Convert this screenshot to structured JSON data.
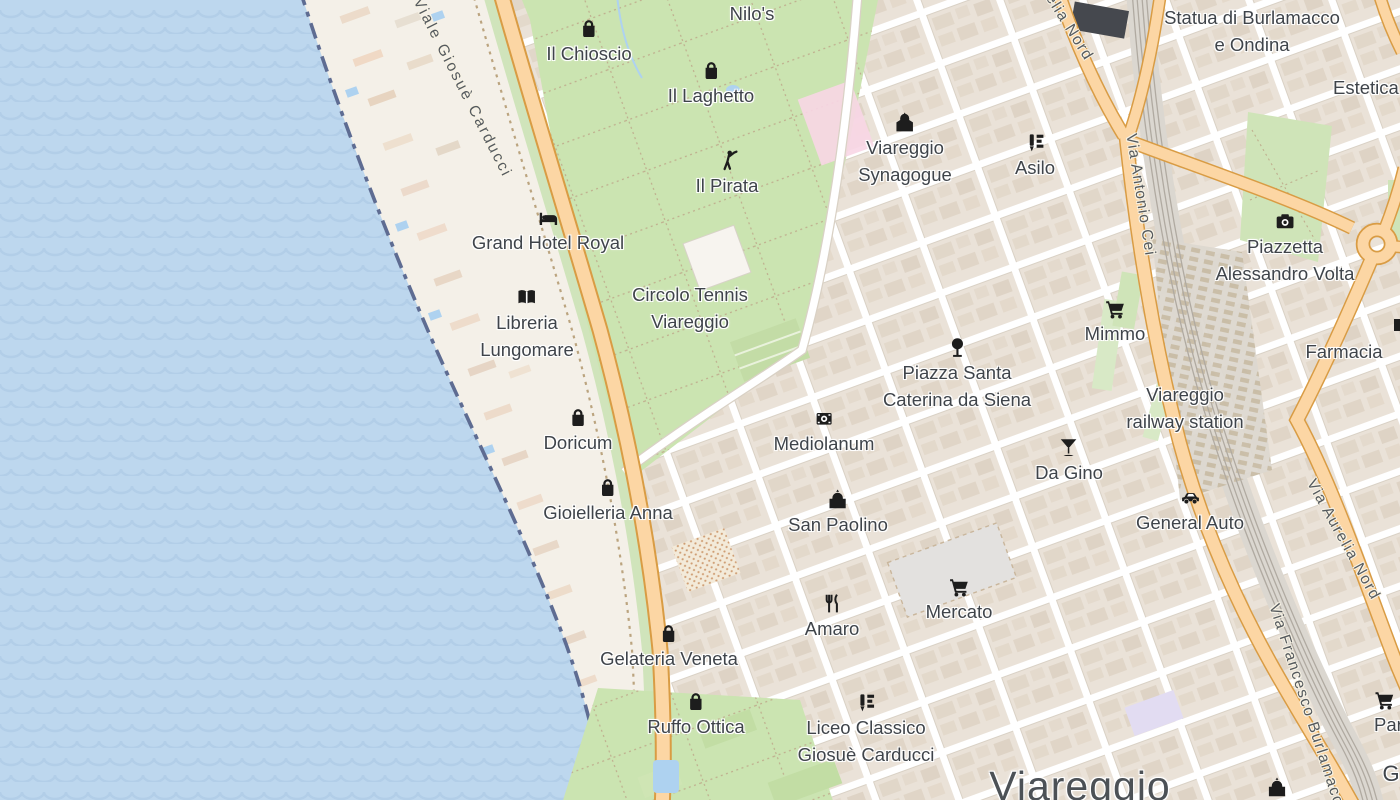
{
  "map": {
    "city_label": {
      "text": "Viareggio",
      "x": 1080,
      "y": 763
    },
    "pois": [
      {
        "id": "nilos",
        "x": 752,
        "y": 0,
        "icon": null,
        "lines": [
          "Nilo's"
        ]
      },
      {
        "id": "il-chioscio",
        "x": 589,
        "y": 18,
        "icon": "shopping-bag",
        "lines": [
          "Il Chioscio"
        ]
      },
      {
        "id": "il-laghetto",
        "x": 711,
        "y": 60,
        "icon": "shopping-bag",
        "lines": [
          "Il Laghetto"
        ]
      },
      {
        "id": "il-pirata",
        "x": 727,
        "y": 150,
        "icon": "golfer",
        "lines": [
          "Il Pirata"
        ]
      },
      {
        "id": "statua-burlamacco",
        "x": 1252,
        "y": 4,
        "icon": null,
        "lines": [
          "Statua di Burlamacco",
          "e Ondina"
        ]
      },
      {
        "id": "viareggio-synagogue",
        "x": 905,
        "y": 112,
        "icon": "synagogue",
        "lines": [
          "Viareggio",
          "Synagogue"
        ]
      },
      {
        "id": "asilo",
        "x": 1035,
        "y": 132,
        "icon": "school",
        "lines": [
          "Asilo"
        ]
      },
      {
        "id": "estetica",
        "x": 1333,
        "y": 74,
        "icon": null,
        "lines": [
          "Estetica"
        ],
        "anchor": "left"
      },
      {
        "id": "grand-hotel-royal",
        "x": 548,
        "y": 207,
        "icon": "bed",
        "lines": [
          "Grand Hotel Royal"
        ]
      },
      {
        "id": "piazzetta-volta",
        "x": 1285,
        "y": 211,
        "icon": "camera",
        "lines": [
          "Piazzetta",
          "Alessandro Volta"
        ]
      },
      {
        "id": "circolo-tennis",
        "x": 690,
        "y": 281,
        "icon": null,
        "lines": [
          "Circolo Tennis",
          "Viareggio"
        ]
      },
      {
        "id": "libreria-lungomare",
        "x": 527,
        "y": 287,
        "icon": "book",
        "lines": [
          "Libreria",
          "Lungomare"
        ]
      },
      {
        "id": "mimmo",
        "x": 1115,
        "y": 298,
        "icon": "cart",
        "lines": [
          "Mimmo"
        ]
      },
      {
        "id": "piazza-caterina",
        "x": 957,
        "y": 337,
        "icon": "tree",
        "lines": [
          "Piazza Santa",
          "Caterina da Siena"
        ]
      },
      {
        "id": "farmacia",
        "x": 1344,
        "y": 338,
        "icon": null,
        "lines": [
          "Farmacia"
        ]
      },
      {
        "id": "railway-station",
        "x": 1185,
        "y": 381,
        "icon": null,
        "lines": [
          "Viareggio",
          "railway station"
        ]
      },
      {
        "id": "doricum",
        "x": 578,
        "y": 407,
        "icon": "shopping-bag",
        "lines": [
          "Doricum"
        ]
      },
      {
        "id": "mediolanum",
        "x": 824,
        "y": 408,
        "icon": "bank",
        "lines": [
          "Mediolanum"
        ]
      },
      {
        "id": "da-gino",
        "x": 1069,
        "y": 437,
        "icon": "cocktail",
        "lines": [
          "Da Gino"
        ]
      },
      {
        "id": "gioielleria-anna",
        "x": 608,
        "y": 477,
        "icon": "shopping-bag",
        "lines": [
          "Gioielleria Anna"
        ]
      },
      {
        "id": "general-auto",
        "x": 1190,
        "y": 487,
        "icon": "car",
        "lines": [
          "General Auto"
        ]
      },
      {
        "id": "san-paolino",
        "x": 838,
        "y": 489,
        "icon": "church",
        "lines": [
          "San Paolino"
        ]
      },
      {
        "id": "mercato",
        "x": 959,
        "y": 576,
        "icon": "cart",
        "lines": [
          "Mercato"
        ]
      },
      {
        "id": "amaro",
        "x": 832,
        "y": 593,
        "icon": "restaurant",
        "lines": [
          "Amaro"
        ]
      },
      {
        "id": "gelateria-veneta",
        "x": 669,
        "y": 623,
        "icon": "shopping-bag",
        "lines": [
          "Gelateria Veneta"
        ]
      },
      {
        "id": "par-partial",
        "x": 1374,
        "y": 689,
        "icon": "cart",
        "lines": [
          "Par"
        ],
        "anchor": "left"
      },
      {
        "id": "ruffo-ottica",
        "x": 696,
        "y": 691,
        "icon": "shopping-bag",
        "lines": [
          "Ruffo Ottica"
        ]
      },
      {
        "id": "liceo-carducci",
        "x": 866,
        "y": 692,
        "icon": "school",
        "lines": [
          "Liceo Classico",
          "Giosuè Carducci"
        ]
      },
      {
        "id": "g-partial",
        "x": 1391,
        "y": 760,
        "icon": null,
        "lines": [
          "G"
        ],
        "size": 22
      },
      {
        "id": "church-bottom",
        "x": 1277,
        "y": 777,
        "icon": "church",
        "lines": []
      }
    ],
    "road_labels": [
      {
        "id": "viale-giosue-carducci",
        "text": "Viale Giosuè Carducci",
        "x": 462,
        "y": 88,
        "rot": 63,
        "ls": 2.2
      },
      {
        "id": "via-aurelia-nord-top",
        "text": "Via Aurelia Nord",
        "x": 1053,
        "y": 2,
        "rot": 58,
        "ls": 1.5
      },
      {
        "id": "via-antonio-cei",
        "text": "Via Antonio Cei",
        "x": 1140,
        "y": 195,
        "rot": 81,
        "ls": 1.2
      },
      {
        "id": "via-aurelia-nord-right",
        "text": "Via Aurelia Nord",
        "x": 1343,
        "y": 540,
        "rot": 61,
        "ls": 1.5
      },
      {
        "id": "via-francesco-burlamacchi",
        "text": "Via Francesco Burlamacchi",
        "x": 1308,
        "y": 712,
        "rot": 72,
        "ls": 1.5
      }
    ],
    "colors": {
      "sea": "#bdd7ee",
      "wave": "#b2cee8",
      "land": "#f2efe9",
      "city_block": "#eae2d8",
      "street": "#ffffff",
      "park": "#cbe4b1",
      "primary_road": "#fcd6a4",
      "primary_casing": "#d99c44",
      "railway": "#b0aaa1",
      "coastline": "#5e6c92",
      "label": "#3f444a",
      "beach": "#f4f0e8",
      "water_feature": "#aed2f0",
      "hospital_pink": "#f8d6e6",
      "market": "#e3e1df"
    }
  }
}
